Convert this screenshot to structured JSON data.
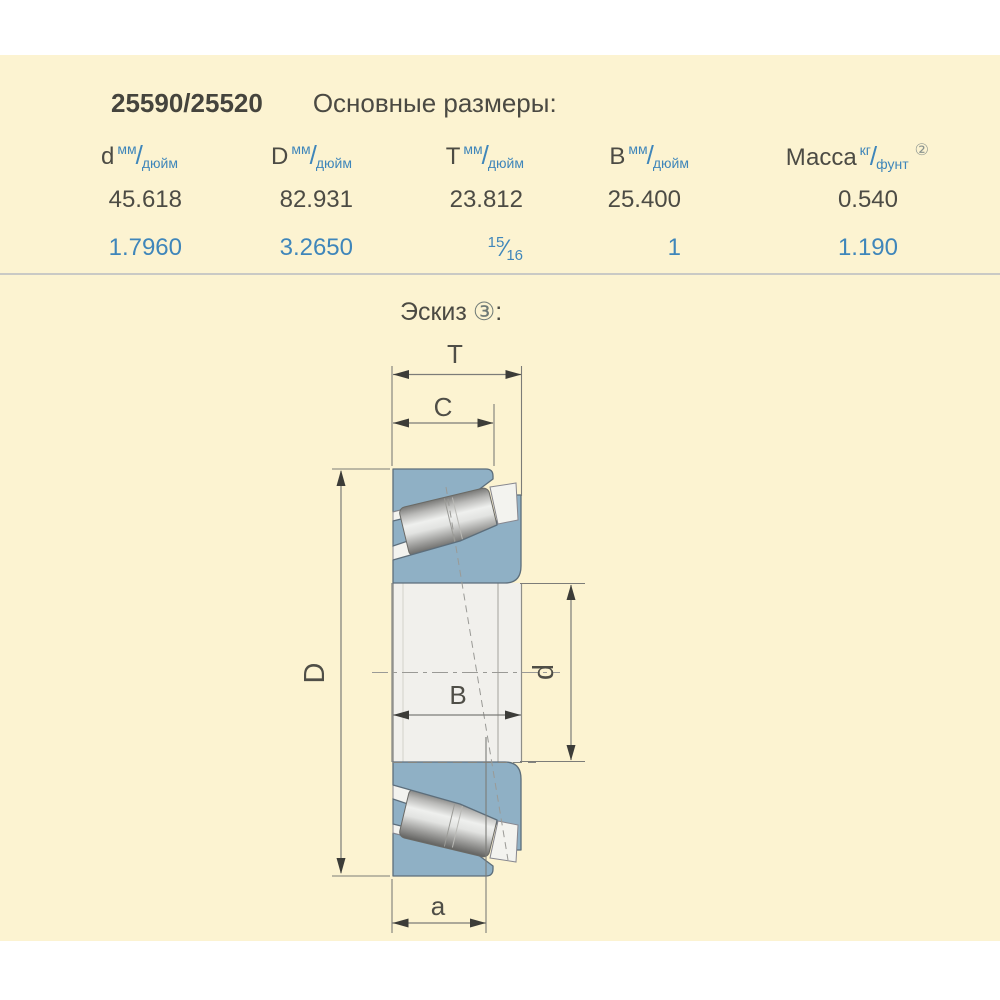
{
  "header": {
    "part_number": "25590/25520",
    "title": "Основные размеры:"
  },
  "table": {
    "columns": [
      {
        "symbol": "d",
        "unit_top": "мм",
        "unit_slash": "/",
        "unit_bottom": "дюйм"
      },
      {
        "symbol": "D",
        "unit_top": "мм",
        "unit_slash": "/",
        "unit_bottom": "дюйм"
      },
      {
        "symbol": "T",
        "unit_top": "мм",
        "unit_slash": "/",
        "unit_bottom": "дюйм"
      },
      {
        "symbol": "B",
        "unit_top": "мм",
        "unit_slash": "/",
        "unit_bottom": "дюйм"
      },
      {
        "symbol": "Масса",
        "unit_top": "кг",
        "unit_slash": "/",
        "unit_bottom": "фунт",
        "footnote": "②"
      }
    ],
    "row_mm": {
      "d": "45.618",
      "D": "82.931",
      "T": "23.812",
      "B": "25.400",
      "mass": "0.540"
    },
    "row_inch": {
      "d": "1.7960",
      "D": "3.2650",
      "T_fraction": {
        "numerator": "15",
        "slash": "⁄",
        "denominator": "16"
      },
      "B": "1",
      "mass": "1.190"
    }
  },
  "sketch": {
    "section_title": "Эскиз",
    "footnote": "③",
    "suffix": ":",
    "labels": {
      "T": "T",
      "C": "C",
      "D": "D",
      "d": "d",
      "B": "B",
      "a": "a"
    }
  },
  "colors": {
    "background": "#ffffff",
    "panel": "#fcf3d1",
    "text_dark": "#4c4b44",
    "text_blue": "#3f86ba",
    "divider": "#c9c9c5",
    "ring_fill": "#8fb0c5",
    "ring_stroke": "#5d6e7b",
    "dim_line": "#7c7c78",
    "roller_light": "#eff0ee",
    "roller_dark": "#626260",
    "bore_fill": "#f1f0ec"
  }
}
